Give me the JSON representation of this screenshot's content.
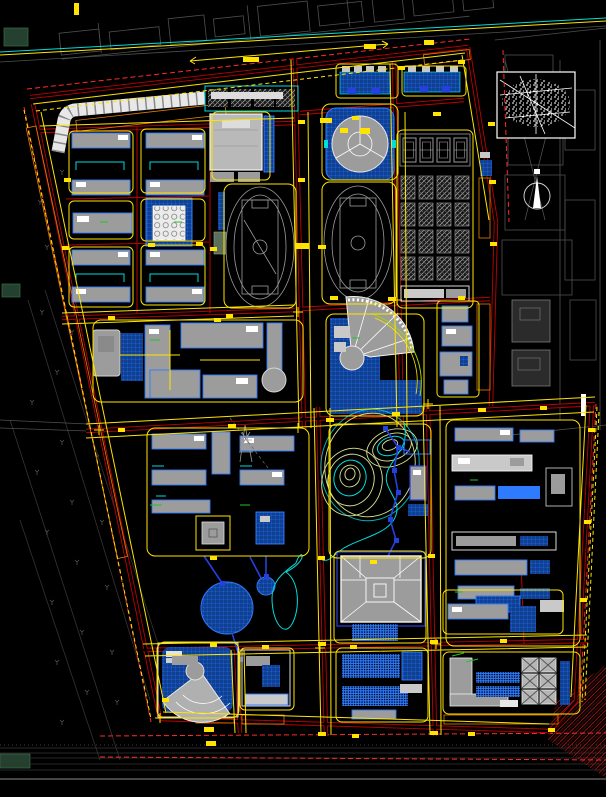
{
  "app": {
    "type": "cad-site-plan-viewport",
    "description": "Campus master plan CAD drawing on black model space, no visible text labels",
    "background": "#000000"
  },
  "palette": {
    "background": "#000000",
    "boundary_red": "#c00000",
    "road_red_bright": "#ff2a2a",
    "curb_yellow": "#ffe400",
    "building_gray": "#9c9c9c",
    "building_light": "#c9c9c9",
    "outline_white": "#f2f2f2",
    "hatch_blue": "#1a5fd6",
    "hatch_blue_bright": "#2e7bff",
    "deep_blue": "#2441e0",
    "cyan": "#00dcdc",
    "contour_green": "#d8e38e",
    "tree_orange": "#e67e00",
    "context_gray": "#4f4f4f",
    "context_dim": "#343434",
    "accent_green": "#22c42a",
    "dark_red_hatch": "#8a1616",
    "panel_green": "#24402e"
  },
  "layers": [
    {
      "name": "site-boundary-and-roads",
      "color": "#c00000"
    },
    {
      "name": "road-centerlines-dashed",
      "color": "#ff2a2a"
    },
    {
      "name": "curb-lines-and-dimensions",
      "color": "#ffe400"
    },
    {
      "name": "buildings-gray",
      "color": "#9c9c9c"
    },
    {
      "name": "building-outlines-white",
      "color": "#f2f2f2"
    },
    {
      "name": "plaza-and-water-hatch",
      "color": "#1a5fd6"
    },
    {
      "name": "paths-deep-blue",
      "color": "#2441e0"
    },
    {
      "name": "walkways-cyan",
      "color": "#00dcdc"
    },
    {
      "name": "landscape-contours",
      "color": "#d8e38e"
    },
    {
      "name": "tree-buffer-hatch",
      "color": "#e67e00"
    },
    {
      "name": "city-context",
      "color": "#4f4f4f"
    }
  ],
  "counts": {
    "running_tracks": 2,
    "basketball_courts": 4,
    "dormitory_blocks": 16,
    "x_braced_units": 6,
    "circular_ponds": 2,
    "contour_hills": 2
  },
  "features": [
    "site-boundary",
    "perimeter-roads",
    "internal-road-grid",
    "tree-buffer-strips",
    "residential-slab-blocks",
    "lecture-hall-circle-grid",
    "canteen-complex",
    "existing-hatched-row",
    "running-track-west",
    "running-track-east",
    "gymnasium-round-hall",
    "basketball-court-row",
    "dormitory-grid-4x4",
    "teaching-complex-west",
    "fan-shaped-hall",
    "hillside-contour-park",
    "stream",
    "lake-ponds",
    "courtyard-main-building",
    "plaza-grids",
    "arc-shaped-hall",
    "workshop-x-braced-block",
    "right-campus-blocks",
    "location-inset-map",
    "north-arrow-compass",
    "west-farmland-context",
    "north-city-context",
    "east-city-context",
    "south-rail-corridor",
    "dimension-markers"
  ]
}
